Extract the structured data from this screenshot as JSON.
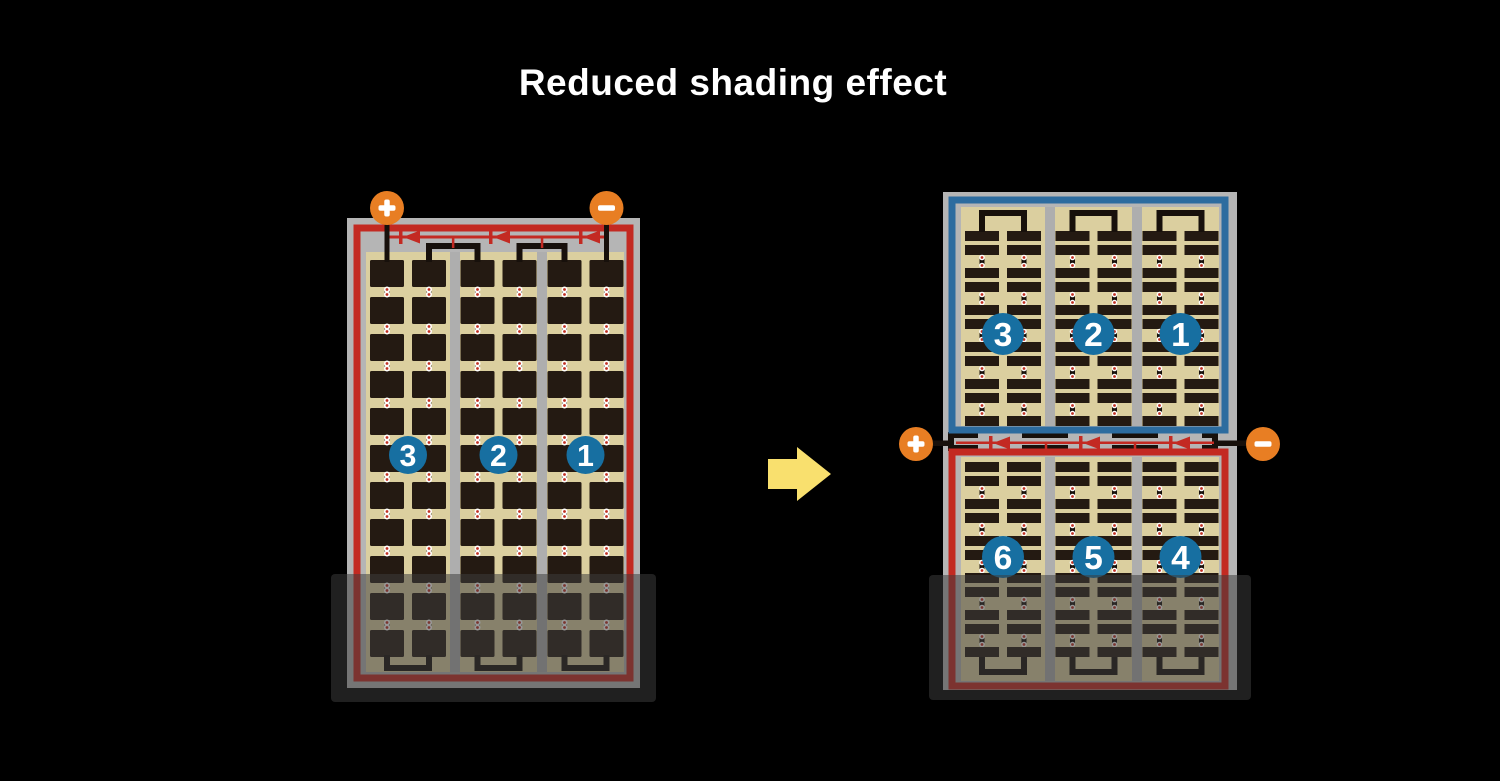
{
  "title": "Reduced shading effect",
  "colors": {
    "background": "#000000",
    "title_text": "#ffffff",
    "frame_gray": "#b5b5b5",
    "divider_gray": "#aeaeae",
    "red_border": "#c32a22",
    "blue_border": "#2d6c9f",
    "cell_bg_tan": "#dbcf9f",
    "cell_dark": "#241a12",
    "trace_black": "#17100b",
    "diode_red": "#c32a22",
    "terminal_orange": "#e87e23",
    "terminal_symbol_white": "#ffffff",
    "number_circle_blue": "#176fa1",
    "number_text_white": "#ffffff",
    "arrow_yellow": "#f9e06e",
    "shade_overlay": "rgba(60,60,60,0.53)",
    "dot_ring_white": "#ffffff",
    "dot_center_red": "#c03022"
  },
  "left_panel": {
    "terminal_plus": "+",
    "terminal_minus": "−",
    "string_labels": [
      "3",
      "2",
      "1"
    ],
    "bypass_diode_count": 3,
    "column_groups": 3,
    "subcolumns_per_group": 2,
    "cell_rows": 11
  },
  "right_panel": {
    "terminal_plus": "+",
    "terminal_minus": "−",
    "top_string_labels": [
      "3",
      "2",
      "1"
    ],
    "bottom_string_labels": [
      "6",
      "5",
      "4"
    ],
    "bypass_diode_count": 3,
    "column_groups": 3,
    "subcolumns_per_group": 2,
    "bar_row_blocks_per_half": 5
  },
  "arrow_direction": "right"
}
